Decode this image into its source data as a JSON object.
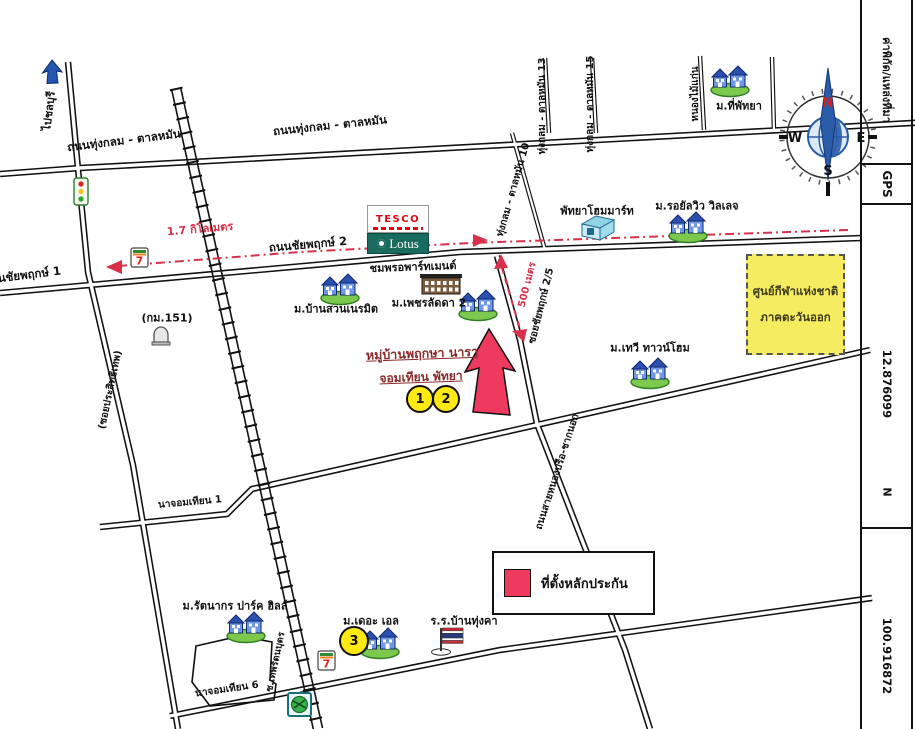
{
  "sidebar": {
    "source_label": "ค่าพิกัด/แหล่งที่มา",
    "source_value": "GPS",
    "latitude": "12.876099",
    "lat_hemisphere": "N",
    "longitude": "100.916872"
  },
  "compass": {
    "north": "N",
    "east": "E",
    "south": "S",
    "west": "W"
  },
  "route": {
    "distance_west": "1.7 กิโลเมตร",
    "distance_soi": "500 เมตร",
    "color": "#d8304a"
  },
  "destination": {
    "name_line1": "หมู่บ้านพฤกษา นารา",
    "name_line2": "จอมเทียน พัทยา",
    "marker1": "1",
    "marker2": "2",
    "marker3": "3"
  },
  "legend": {
    "marker_label": "ที่ตั้งหลักประกัน",
    "marker_color": "#ee3a5e"
  },
  "roads": {
    "thung_klom_tan_man_west": "ถนนทุ่งกลม - ตาลหมัน",
    "thung_klom_tan_man_east": "ถนนทุ่งกลม - ตาลหมัน",
    "chaiyapruek_1": "ถนนชัยพฤกษ์ 1",
    "chaiyapruek_2": "ถนนชัยพฤกษ์ 2",
    "soi_13": "ทุ่งกลม - ตาลหมัน 13",
    "soi_15": "ทุ่งกลม - ตาลหมัน 15",
    "soi_10": "ทุ่งกลม - ตาลหมัน 10",
    "nong_mai_kaen": "หนองไม้แก่น",
    "soi_chaiyapruek_2_5": "ซอยชัยพฤกษ์ 2/5",
    "nong_prue_chak_nok": "ถนนสายหนองปรือ-ชากนอก",
    "na_jomtien_1": "นาจอมเทียน 1",
    "na_jomtien_6": "นาจอมเทียน 6",
    "soi_thep_rattana_but": "ซ.เทพรัตนบุตร",
    "soi_prasitthep": "(ซอยประสิทธิเทพ)",
    "to_chonburi": "ไปชลบุรี",
    "km_151": "(กม.151)"
  },
  "places": {
    "tee_pattaya": "ม.ที่พัทยา",
    "royal_view_village": "ม.รอยัลวิว วิลเลจ",
    "pattaya_homemart": "พัทยาโฮมมาร์ท",
    "chomporn_apartment": "ชมพรอพาร์ทเมนต์",
    "phet_ladda_2": "ม.เพชรลัดดา 2",
    "baan_suan_neramit": "ม.บ้านสวนเนรมิต",
    "tavee_townhome": "ม.เทวี ทาวน์โฮม",
    "rattanakorn_park_hill": "ม.รัตนากร ปาร์ค ฮิลล์",
    "the_l": "ม.เดอะ เอล",
    "baan_thung_kha_school": "ร.ร.บ้านทุ่งคา",
    "sport_center_line1": "ศูนย์กีฬาแห่งชาติ",
    "sport_center_line2": "ภาคตะวันออก"
  },
  "brands": {
    "tesco": "TESCO",
    "lotus": "Lotus",
    "seven": "7"
  }
}
